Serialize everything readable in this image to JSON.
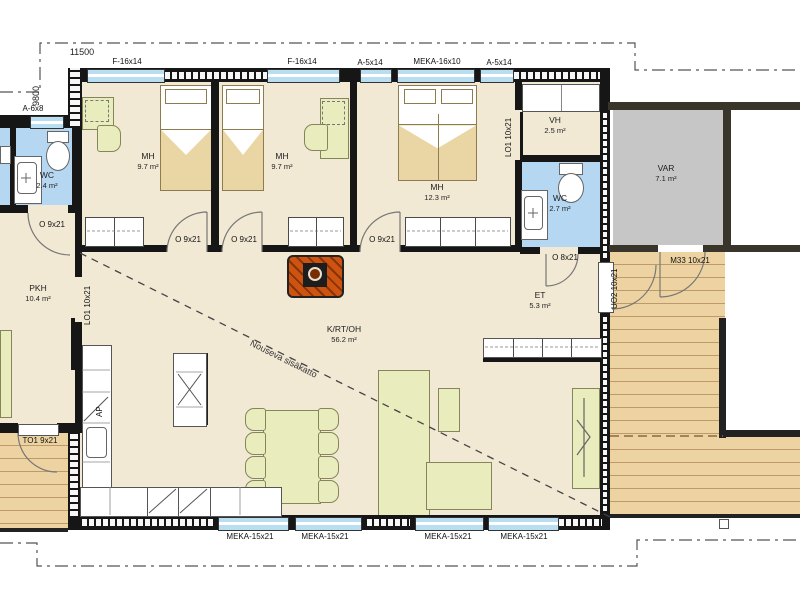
{
  "site": {
    "width_dim": "11500",
    "height_dim": "9800"
  },
  "windows": {
    "left": "A-6x8",
    "top": [
      "F-16x14",
      "F-16x14",
      "A-5x14",
      "MEKA-16x10",
      "A-5x14"
    ],
    "bottom": [
      "MEKA-15x21",
      "MEKA-15x21",
      "MEKA-15x21",
      "MEKA-15x21"
    ]
  },
  "rooms": {
    "wc_left": {
      "name": "WC",
      "area": "2.4 m²"
    },
    "mh1": {
      "name": "MH",
      "area": "9.7 m²"
    },
    "mh2": {
      "name": "MH",
      "area": "9.7 m²"
    },
    "mh3": {
      "name": "MH",
      "area": "12.3 m²"
    },
    "vh": {
      "name": "VH",
      "area": "2.5 m²"
    },
    "wc_right": {
      "name": "WC",
      "area": "2.7 m²"
    },
    "var": {
      "name": "VAR",
      "area": "7.1 m²"
    },
    "et": {
      "name": "ET",
      "area": "5.3 m²"
    },
    "pkh": {
      "name": "PKH",
      "area": "10.4 m²"
    },
    "krtoh": {
      "name": "K/RT/OH",
      "area": "56.2 m²"
    }
  },
  "doors": {
    "mh1": "O 9x21",
    "mh2": "O 9x21",
    "mh3": "O 9x21",
    "pkh": "O 9x21",
    "wc_right": "O 8x21",
    "pkh_slider": "LO1 10x21",
    "vh_slider": "LO1 10x21",
    "entry": "UO2 10x21",
    "var": "M33 10x21",
    "terrace": "TO1 9x21"
  },
  "annotations": {
    "ceiling": "Nouseva sisäkatto",
    "dishwasher": "AP"
  },
  "colors": {
    "floor": "#f2e9d5",
    "wet_room": "#b5d7f1",
    "deck_wood": "#eed3a2",
    "storage": "#c6c6c6",
    "furniture": "#e9edbd",
    "bedding": "#ead5a4",
    "fireplace": "#cf5310",
    "wall": "#161616",
    "window": "#b9def1"
  }
}
